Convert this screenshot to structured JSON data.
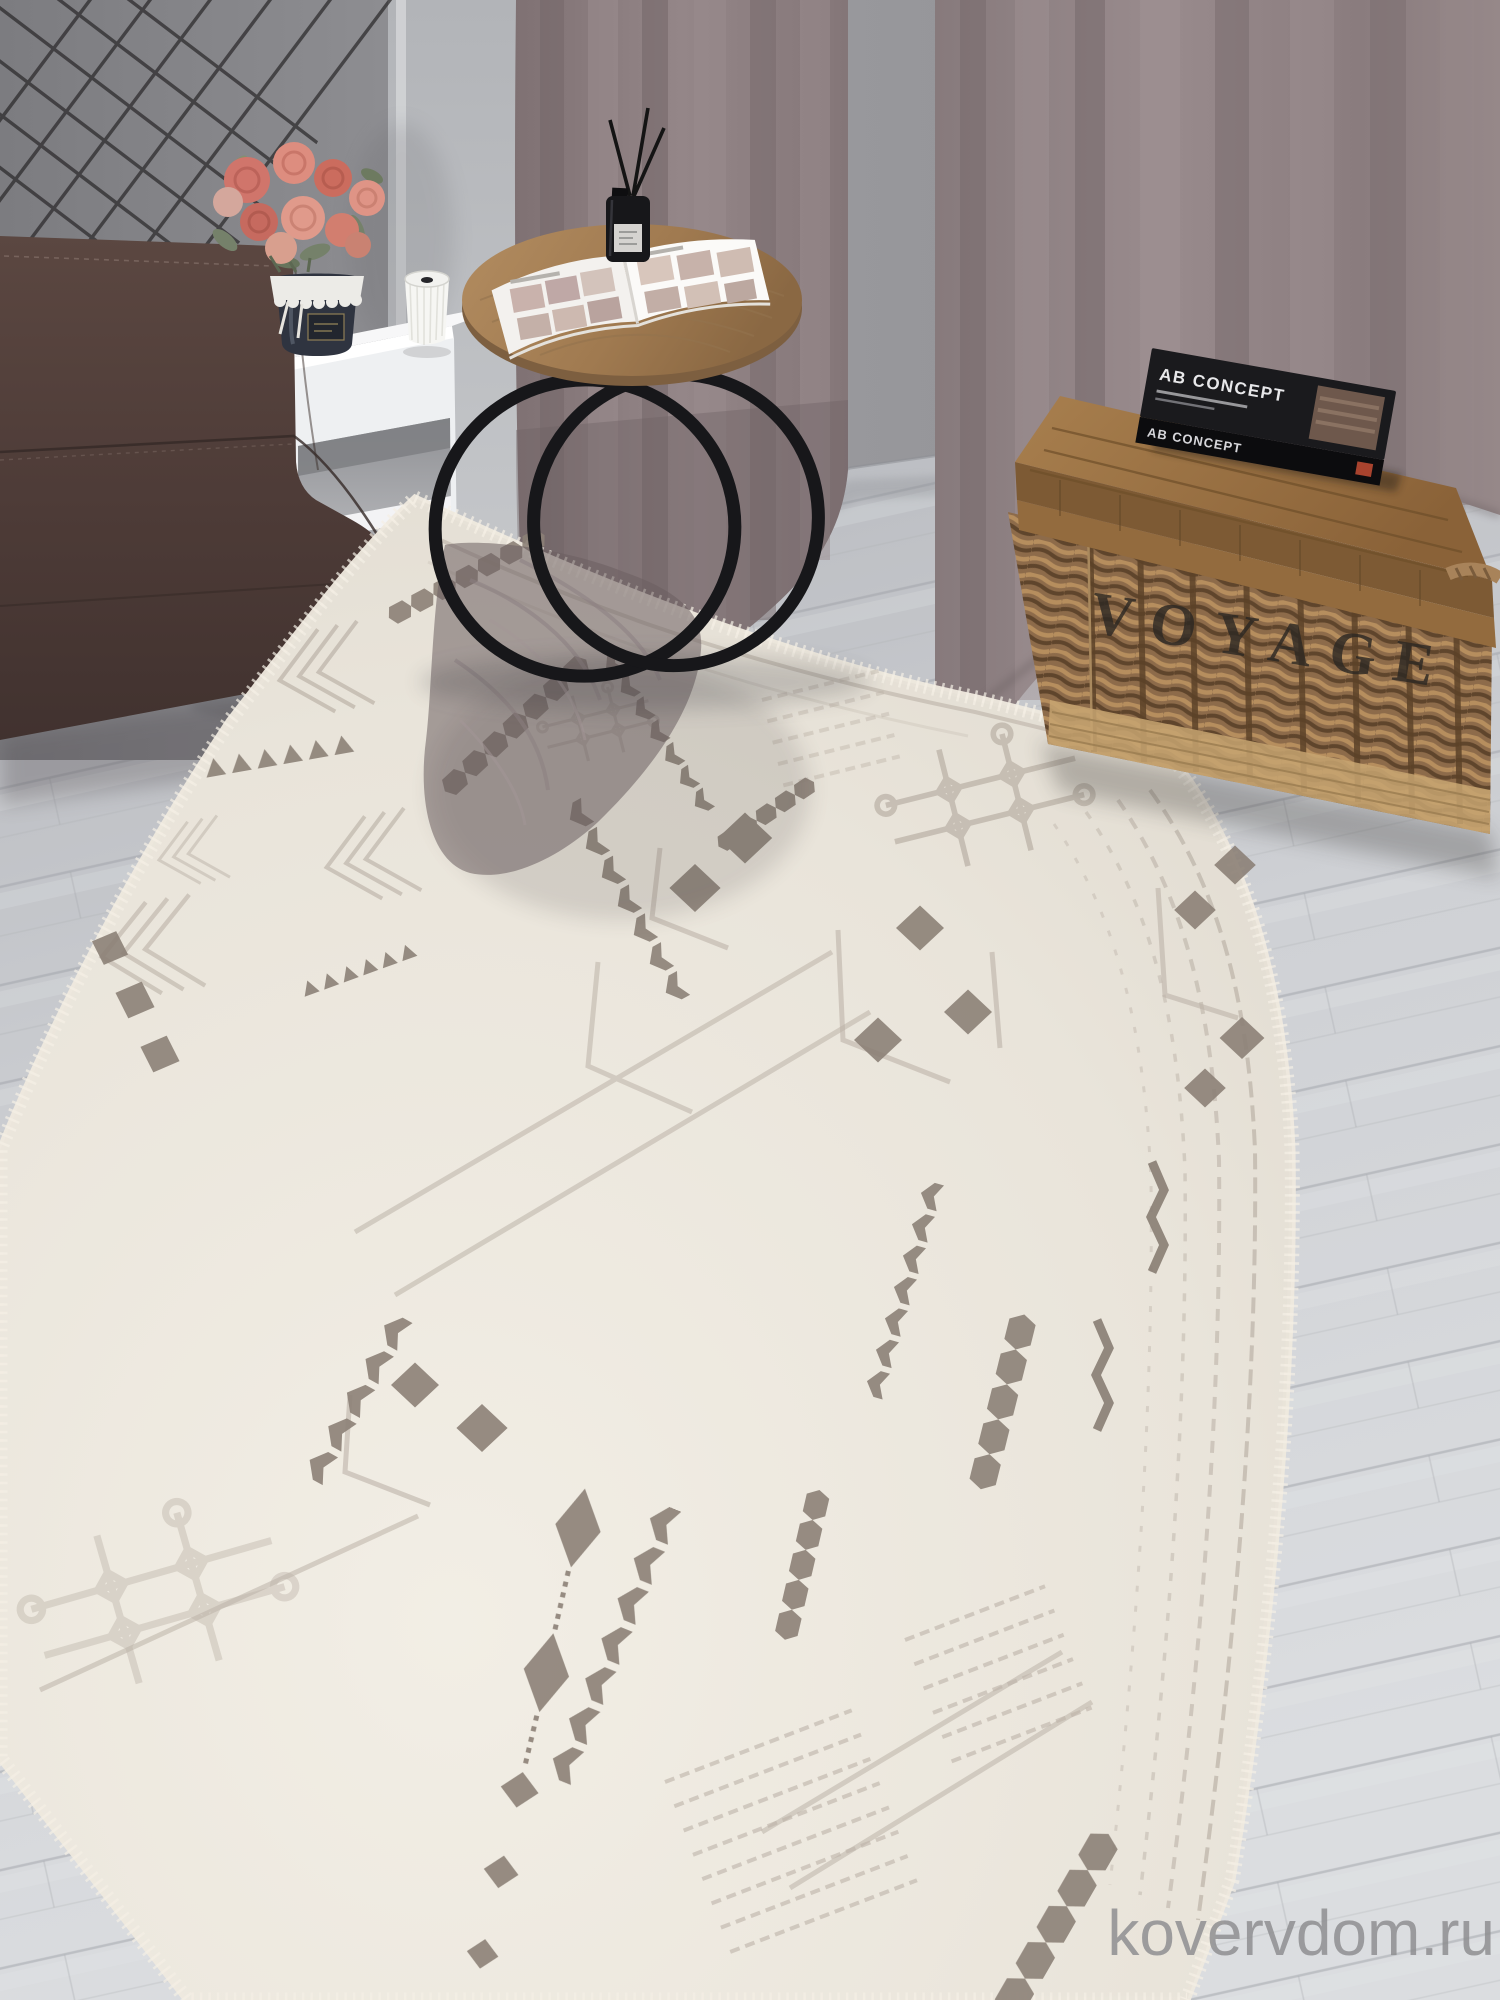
{
  "scene": {
    "watermark": {
      "text": "kovervdom.ru",
      "color": "#8f8f91"
    },
    "basket": {
      "label": "VOYAGE"
    },
    "book": {
      "title": "AB CONCEPT",
      "spine": "AB CONCEPT"
    },
    "palette": {
      "rug_base": "#e9e4da",
      "rug_motif_dark": "#8c8177",
      "rug_motif_light": "#bcb3a8",
      "sofa": "#53403c",
      "curtain": "#8e8082",
      "wall": "#97979b",
      "floor": "#cdd0d4",
      "basket_wicker": "#8d6b4a",
      "basket_lid": "#9d7747",
      "table_wood": "#a8845c",
      "table_legs": "#17171a",
      "flowers": "#d4796c",
      "nightstand": "#f0f1f3"
    }
  }
}
